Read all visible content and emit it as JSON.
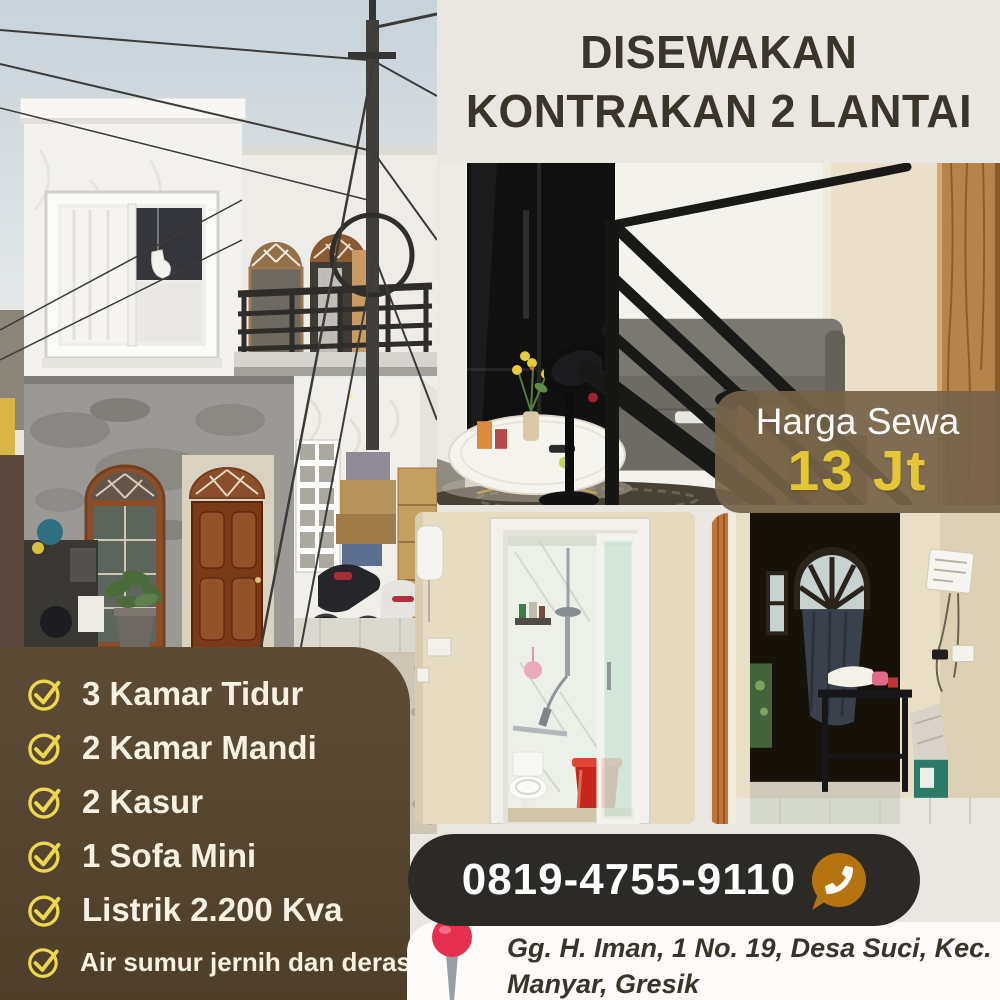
{
  "title": {
    "line1": "DISEWAKAN",
    "line2": "KONTRAKAN 2 LANTAI"
  },
  "price": {
    "label": "Harga Sewa",
    "value": "13 Jt"
  },
  "features": [
    "3 Kamar Tidur",
    "2 Kamar Mandi",
    "2 Kasur",
    "1 Sofa Mini",
    "Listrik 2.200 Kva",
    "Air sumur jernih dan deras"
  ],
  "contact": {
    "phone": "0819-4755-9110",
    "icon": "whatsapp-phone-icon"
  },
  "address": {
    "line1": "Gg. H. Iman, 1 No. 19, Desa Suci, Kec.",
    "line2": "Manyar, Gresik",
    "icon": "map-pin-icon"
  },
  "photos": [
    {
      "name": "house-exterior",
      "label": "Two-story white house front with utility pole"
    },
    {
      "name": "staircase-living-room",
      "label": "Black stair railing, sofa, side table with flowers, fan"
    },
    {
      "name": "bathroom",
      "label": "Shower room with toilet and red bucket"
    },
    {
      "name": "room-arched-window",
      "label": "Room with arched window, dark curtain and desk"
    }
  ],
  "colors": {
    "background": "#eae7e3",
    "title_text": "#3b342b",
    "panel_brown": "#554634",
    "feature_text": "#f7f1e3",
    "check_yellow": "#ecd84e",
    "price_band": "#74634a",
    "price_value_yellow": "#e5c637",
    "phone_pill": "#2c2a27",
    "whatsapp_orange": "#b5740f",
    "pin_red": "#e73050",
    "address_text": "#3a332b"
  }
}
